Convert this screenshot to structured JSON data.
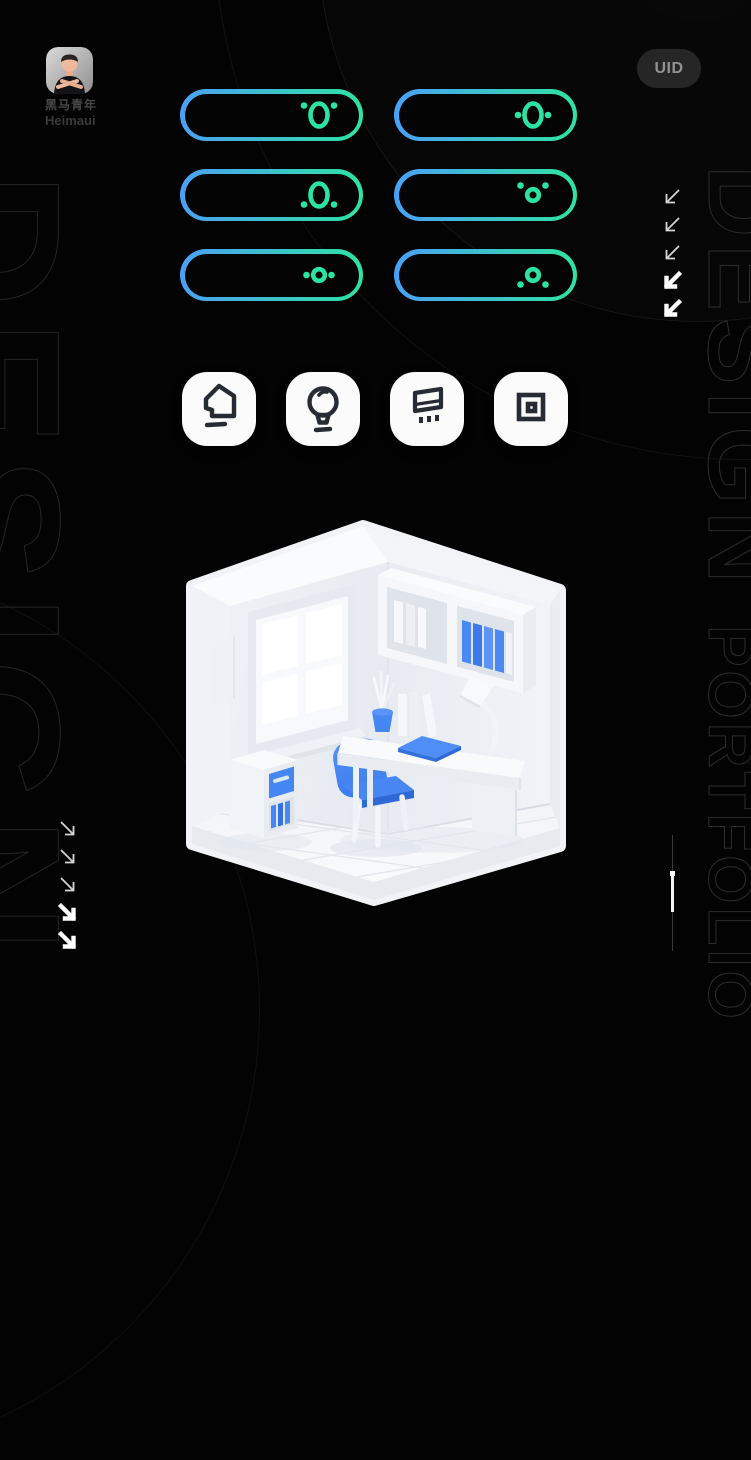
{
  "profile": {
    "name_zh": "黑马青年",
    "name_en": "Heimaui",
    "avatar": "memoji-man-crossed-arms"
  },
  "uid_badge": {
    "label": "UID"
  },
  "toggles": {
    "border_gradient": [
      "#4aa0f5",
      "#2fe3a2"
    ],
    "glyph_color": "#2be3a3",
    "items": [
      {
        "ring": "large",
        "dots": "top"
      },
      {
        "ring": "large",
        "dots": "middle"
      },
      {
        "ring": "large",
        "dots": "bottom"
      },
      {
        "ring": "small",
        "dots": "top"
      },
      {
        "ring": "small",
        "dots": "middle"
      },
      {
        "ring": "small",
        "dots": "bottom"
      }
    ]
  },
  "icon_tiles": [
    {
      "name": "home"
    },
    {
      "name": "lightbulb"
    },
    {
      "name": "billboard"
    },
    {
      "name": "frame"
    }
  ],
  "decor": {
    "left_vertical_text": "DESIGN",
    "right_vertical_text_1": "DESIGN ",
    "right_vertical_text_2": "PORTFOLIO",
    "arrow_groups": {
      "right_side": {
        "direction": "down-left",
        "styles": [
          "outline",
          "outline",
          "outline",
          "fill",
          "fill"
        ]
      },
      "bottom_left": {
        "direction": "down-right",
        "styles": [
          "outline",
          "outline",
          "outline",
          "fill",
          "fill"
        ]
      }
    }
  },
  "illustration": {
    "description": "isometric white study room: window wall, wall shelf with white and blue books, desk with lamp, plant pot and blue notebook, blue chair, drawer cabinet with blue drawer and books",
    "accent_blue": "#4486f2"
  }
}
